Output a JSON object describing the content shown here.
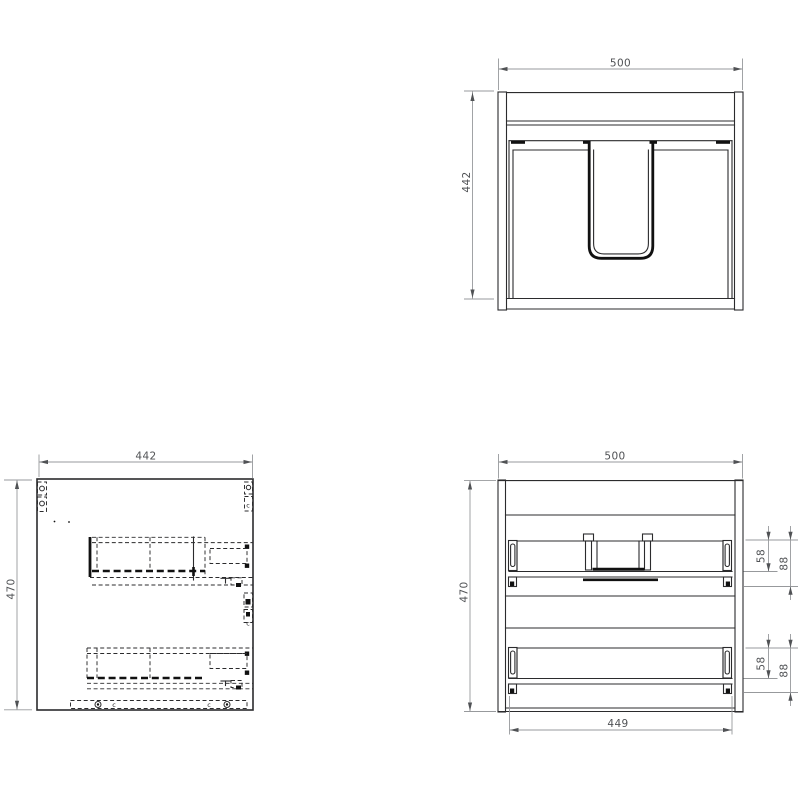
{
  "drawing": {
    "colors": {
      "object_line": "#2b2b2d",
      "heavy_line": "#111111",
      "dimension_line": "#97999c",
      "dimension_text": "#505255",
      "background": "#ffffff"
    },
    "top_view": {
      "width": "500",
      "depth": "442"
    },
    "side_view": {
      "width": "442",
      "height": "470",
      "cam_marks": [
        "c",
        "c",
        "c",
        "c"
      ]
    },
    "front_view": {
      "width": "500",
      "height": "470",
      "drawer_width": "449",
      "upper_drawer": {
        "back_height": "58",
        "overall_height": "88"
      },
      "lower_drawer": {
        "back_height": "58",
        "overall_height": "88"
      }
    }
  }
}
